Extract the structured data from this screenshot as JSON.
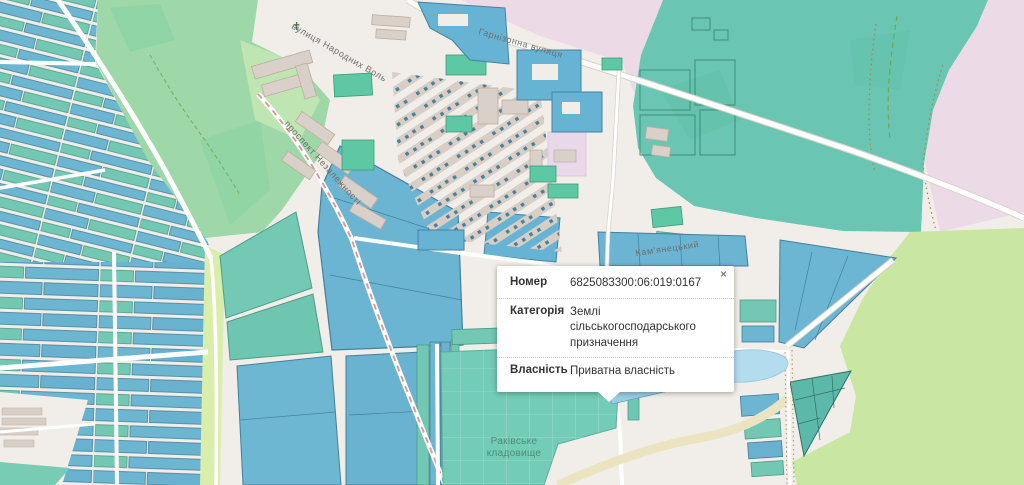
{
  "popup": {
    "close_label": "×",
    "rows": [
      {
        "label": "Номер",
        "value": "6825083300:06:019:0167"
      },
      {
        "label": "Категорія",
        "value": "Землі сільськогосподарського призначення"
      },
      {
        "label": "Власність",
        "value": "Приватна власність"
      }
    ]
  },
  "map_labels": {
    "street_harnizonna": "Гарнізонна вулиця",
    "street_narodnykh": "вулиця Народних Воль",
    "street_nezalezhnosti": "проспект Незалежності",
    "street_kamianetskyi": "Кам'янецький",
    "cemetery_line1": "Раківське",
    "cemetery_line2": "кладовище",
    "church_marker": "✝"
  },
  "colors": {
    "background": "#f1eee9",
    "parcel_blue": "#6bb5d2",
    "parcel_teal": "#72c8b3",
    "selected_parcel": "#2b96c9",
    "zone_pink": "#ecdbe6",
    "zone_teal_farmland": "#6ac6b2",
    "grass_green": "#c9e7a2",
    "park_green": "#9ed7a8",
    "building_gray": "#d9d0c9",
    "water": "#b3ddee",
    "road_red_dash": "#e09393"
  }
}
